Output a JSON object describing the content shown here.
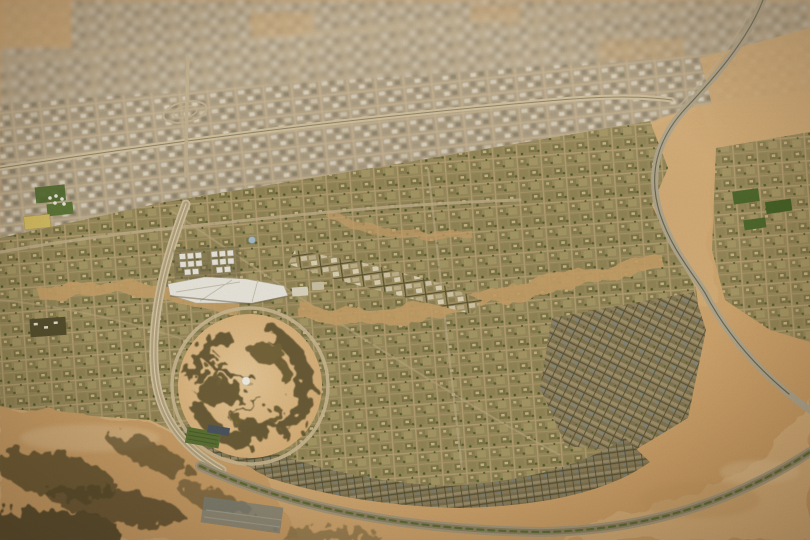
{
  "scene": {
    "title": "Aerial view of a desert master-planned city",
    "type": "aerial-photograph-tilt-shift",
    "description": "Oblique tilt-shift aerial render of a sprawling sand-colored city: a dense, slightly blurred metropolis grid across the top, a new master-planned community in the centre with olive-green residential districts and a white low-rise downtown, a circular desert park with dark dendritic vegetation and a small white dome at its heart, multi-lane ring roads and curving highways, and open desert with dark scrub patches in the foreground corners."
  },
  "palette": {
    "desert_sand": "#cda26a",
    "desert_sand_light": "#d7b07a",
    "desert_sand_pale": "#e0c191",
    "scrub_dark": "#5e5230",
    "veg_dark": "#645730",
    "park_sand": "#d9b179",
    "city_top_base": "#b2a388",
    "city_mid_base": "#9a8d5e",
    "city_dense_base": "#837853",
    "road_light": "#d2c3a1",
    "road_highway": "#b3aa92",
    "road_minor": "#c2b08c",
    "median_green": "#5f6f33",
    "green_field": "#4f6b2e",
    "orchard_green": "#5d7335",
    "solar_array": "#4c5560",
    "white_roof": "#eceae2",
    "dome_white": "#f5f3ea",
    "blue_dome": "#a9c0cc",
    "yellow_block": "#d6c065",
    "dark_campus": "#55502f",
    "blue_roofs": "#7e8781"
  },
  "features": [
    "old-city-grid-top",
    "upper-highway",
    "highway-interchange",
    "right-curving-highway",
    "central-planned-district",
    "downtown-white-cubes",
    "downtown-canopy-roof",
    "downtown-spine",
    "circular-desert-park",
    "dendritic-vegetation",
    "central-dome-pavilion",
    "park-ring-road",
    "west-avenue",
    "south-boulevard",
    "rowhouse-arc-district",
    "southeast-dense-district",
    "green-sports-fields",
    "orchard-plot",
    "desert-foreground-scrub"
  ]
}
